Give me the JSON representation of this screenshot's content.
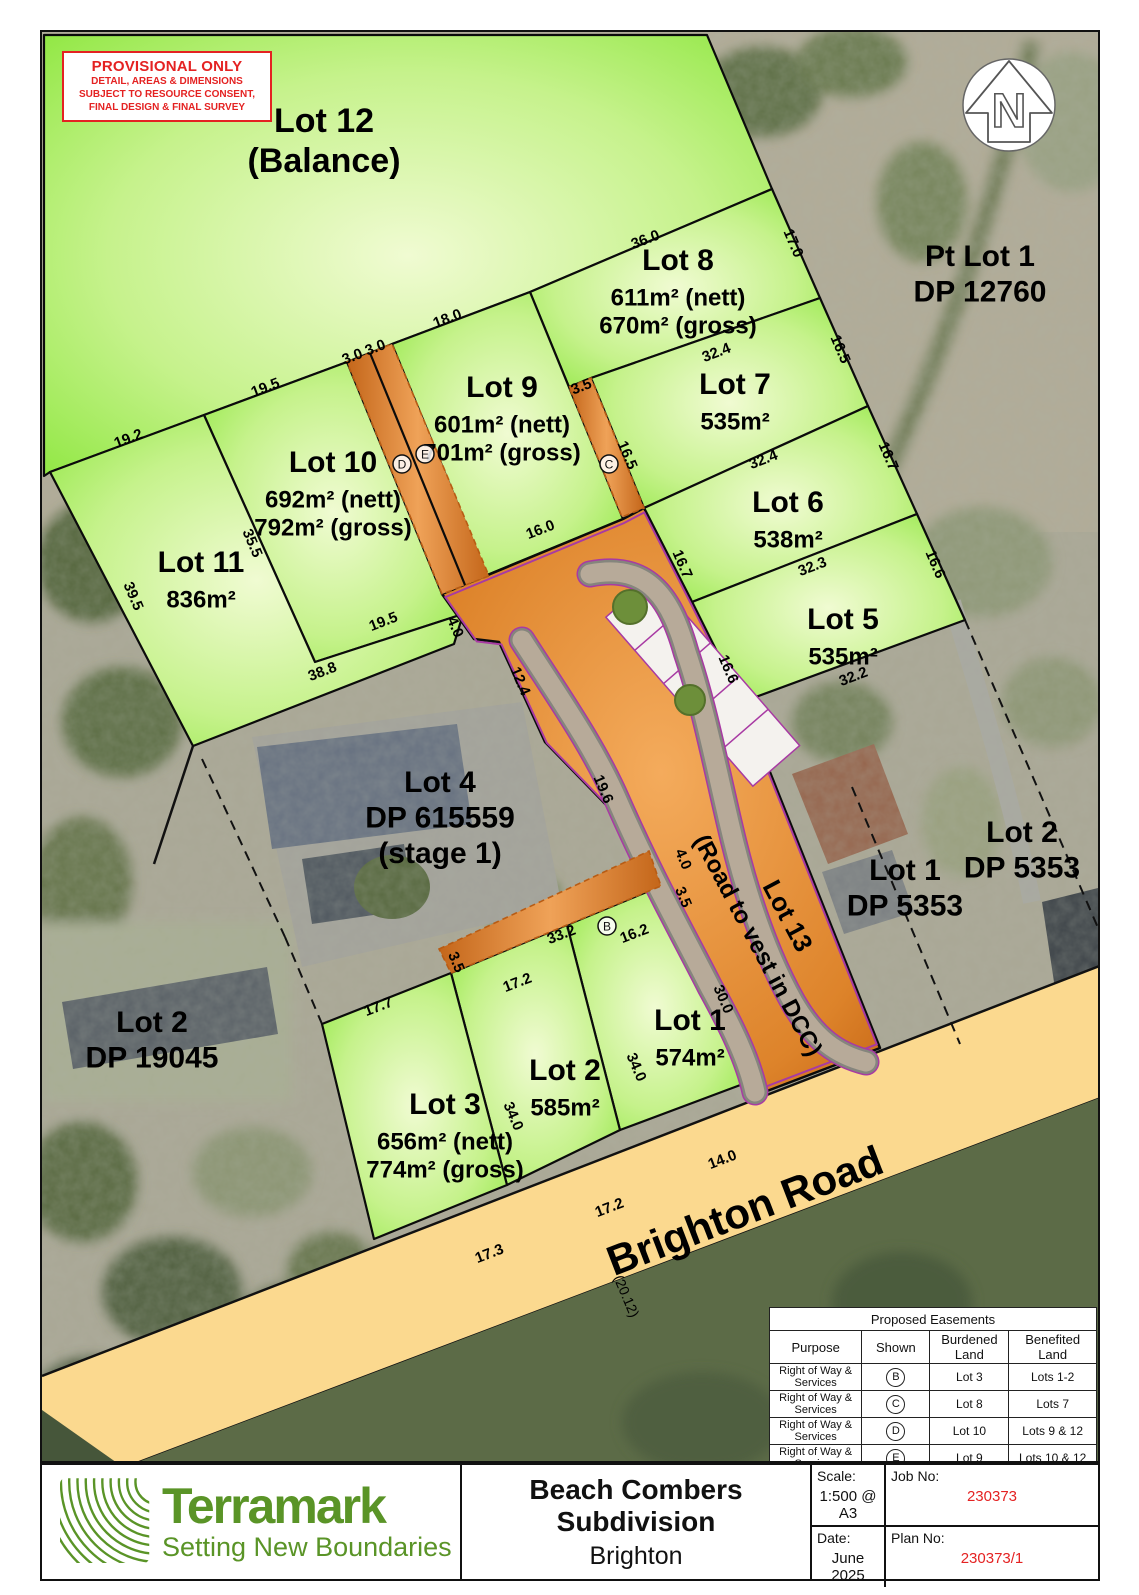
{
  "provisional": {
    "title": "PROVISIONAL ONLY",
    "lines": [
      "DETAIL, AREAS & DIMENSIONS",
      "SUBJECT TO RESOURCE CONSENT,",
      "FINAL DESIGN & FINAL SURVEY"
    ]
  },
  "north": {
    "letter": "N"
  },
  "map": {
    "dimensions": [
      [
        "36.0",
        645,
        242,
        -21
      ],
      [
        "17.0",
        787,
        243,
        67
      ],
      [
        "18.0",
        447,
        321,
        -21
      ],
      [
        "3.0",
        352,
        359,
        -21
      ],
      [
        "3.0",
        375,
        350,
        -21
      ],
      [
        "19.5",
        265,
        390,
        -21
      ],
      [
        "19.2",
        128,
        441,
        -21
      ],
      [
        "3.5",
        581,
        389,
        -21
      ],
      [
        "32.4",
        716,
        355,
        -21
      ],
      [
        "16.5",
        834,
        349,
        67
      ],
      [
        "16.5",
        621,
        455,
        67
      ],
      [
        "32.4",
        763,
        462,
        -21
      ],
      [
        "16.7",
        882,
        456,
        67
      ],
      [
        "16.7",
        676,
        564,
        67
      ],
      [
        "32.3",
        812,
        569,
        -21
      ],
      [
        "16.6",
        929,
        564,
        67
      ],
      [
        "16.6",
        722,
        669,
        67
      ],
      [
        "32.2",
        853,
        679,
        -21
      ],
      [
        "35.5",
        246,
        543,
        67
      ],
      [
        "39.5",
        127,
        596,
        67
      ],
      [
        "19.5",
        383,
        624,
        -21
      ],
      [
        "4.0",
        449,
        627,
        67
      ],
      [
        "38.8",
        322,
        674,
        -21
      ],
      [
        "16.0",
        540,
        532,
        -21
      ],
      [
        "12.4",
        514,
        681,
        67
      ],
      [
        "19.6",
        597,
        789,
        67
      ],
      [
        "4.0",
        677,
        859,
        67
      ],
      [
        "3.5",
        677,
        897,
        67
      ],
      [
        "33.2",
        561,
        937,
        -21
      ],
      [
        "16.2",
        634,
        936,
        -21
      ],
      [
        "17.2",
        517,
        985,
        -21
      ],
      [
        "3.5",
        450,
        962,
        67
      ],
      [
        "17.7",
        378,
        1009,
        -21
      ],
      [
        "30.0",
        717,
        999,
        67
      ],
      [
        "34.0",
        630,
        1067,
        67
      ],
      [
        "34.0",
        507,
        1116,
        67
      ],
      [
        "17.2",
        609,
        1210,
        -21
      ],
      [
        "14.0",
        722,
        1162,
        -21
      ],
      [
        "17.3",
        489,
        1256,
        -21
      ]
    ],
    "road_width_dim": "(20.12)",
    "lot_labels": [
      {
        "name": "lot-12-label",
        "x": 322,
        "y": 130,
        "lines": [
          {
            "t": "Lot 12",
            "s": 34
          },
          {
            "t": "(Balance)",
            "s": 34
          }
        ]
      },
      {
        "name": "pt-lot-1-label",
        "x": 978,
        "y": 264,
        "lines": [
          {
            "t": "Pt Lot 1",
            "s": 30
          },
          {
            "t": "DP 12760",
            "s": 30
          }
        ]
      },
      {
        "name": "lot-8-label",
        "x": 676,
        "y": 268,
        "lines": [
          {
            "t": "Lot 8",
            "s": 30
          },
          {
            "t": "611m² (nett)",
            "s": 24
          },
          {
            "t": "670m² (gross)",
            "s": 24
          }
        ]
      },
      {
        "name": "lot-7-label",
        "x": 733,
        "y": 392,
        "lines": [
          {
            "t": "Lot 7",
            "s": 30
          },
          {
            "t": "535m²",
            "s": 24
          }
        ]
      },
      {
        "name": "lot-9-label",
        "x": 500,
        "y": 395,
        "lines": [
          {
            "t": "Lot 9",
            "s": 30
          },
          {
            "t": "601m² (nett)",
            "s": 24
          },
          {
            "t": "701m² (gross)",
            "s": 24
          }
        ]
      },
      {
        "name": "lot-10-label",
        "x": 331,
        "y": 470,
        "lines": [
          {
            "t": "Lot 10",
            "s": 30
          },
          {
            "t": "692m² (nett)",
            "s": 24
          },
          {
            "t": "792m² (gross)",
            "s": 24
          }
        ]
      },
      {
        "name": "lot-11-label",
        "x": 199,
        "y": 570,
        "lines": [
          {
            "t": "Lot 11",
            "s": 30
          },
          {
            "t": "836m²",
            "s": 24
          }
        ]
      },
      {
        "name": "lot-6-label",
        "x": 786,
        "y": 510,
        "lines": [
          {
            "t": "Lot 6",
            "s": 30
          },
          {
            "t": "538m²",
            "s": 24
          }
        ]
      },
      {
        "name": "lot-5-label",
        "x": 841,
        "y": 627,
        "lines": [
          {
            "t": "Lot 5",
            "s": 30
          },
          {
            "t": "535m²",
            "s": 24
          }
        ]
      },
      {
        "name": "lot-4-label",
        "x": 438,
        "y": 790,
        "lines": [
          {
            "t": "Lot 4",
            "s": 30
          },
          {
            "t": "DP 615559",
            "s": 30
          },
          {
            "t": "(stage 1)",
            "s": 30
          }
        ]
      },
      {
        "name": "lot-1-label",
        "x": 688,
        "y": 1028,
        "lines": [
          {
            "t": "Lot 1",
            "s": 30
          },
          {
            "t": "574m²",
            "s": 24
          }
        ]
      },
      {
        "name": "lot-2-label",
        "x": 563,
        "y": 1078,
        "lines": [
          {
            "t": "Lot 2",
            "s": 30
          },
          {
            "t": "585m²",
            "s": 24
          }
        ]
      },
      {
        "name": "lot-3-label",
        "x": 443,
        "y": 1112,
        "lines": [
          {
            "t": "Lot 3",
            "s": 30
          },
          {
            "t": "656m² (nett)",
            "s": 24
          },
          {
            "t": "774m² (gross)",
            "s": 24
          }
        ]
      },
      {
        "name": "lot-2-dp-19045-label",
        "x": 150,
        "y": 1030,
        "lines": [
          {
            "t": "Lot 2",
            "s": 30
          },
          {
            "t": "DP 19045",
            "s": 30
          }
        ]
      },
      {
        "name": "lot-1-dp-5353-label",
        "x": 903,
        "y": 878,
        "lines": [
          {
            "t": "Lot 1",
            "s": 30
          },
          {
            "t": "DP 5353",
            "s": 30
          }
        ]
      },
      {
        "name": "lot-2-dp-5353-label",
        "x": 1020,
        "y": 840,
        "lines": [
          {
            "t": "Lot 2",
            "s": 30
          },
          {
            "t": "DP 5353",
            "s": 30
          }
        ]
      },
      {
        "name": "lot-13-label",
        "x": 778,
        "y": 918,
        "r": 62,
        "lines": [
          {
            "t": "Lot 13",
            "s": 26
          }
        ]
      },
      {
        "name": "road-vest-label",
        "x": 749,
        "y": 947,
        "r": 62,
        "lines": [
          {
            "t": "(Road to vest in DCC)",
            "s": 24
          }
        ]
      },
      {
        "name": "brighton-road-label",
        "x": 748,
        "y": 1222,
        "r": -21,
        "lines": [
          {
            "t": "Brighton Road",
            "s": 42
          }
        ]
      }
    ],
    "easement_marks": [
      {
        "t": "B",
        "x": 605,
        "y": 924
      },
      {
        "t": "C",
        "x": 607,
        "y": 462
      },
      {
        "t": "D",
        "x": 400,
        "y": 462
      },
      {
        "t": "E",
        "x": 423,
        "y": 452
      }
    ]
  },
  "easements_table": {
    "title": "Proposed Easements",
    "headers": [
      "Purpose",
      "Shown",
      "Burdened Land",
      "Benefited Land"
    ],
    "rows": [
      {
        "purpose": "Right of Way & Services",
        "shown": "B",
        "burdened": "Lot 3",
        "benefited": "Lots 1-2"
      },
      {
        "purpose": "Right of Way & Services",
        "shown": "C",
        "burdened": "Lot 8",
        "benefited": "Lots 7"
      },
      {
        "purpose": "Right of Way & Services",
        "shown": "D",
        "burdened": "Lot 10",
        "benefited": "Lots 9 & 12"
      },
      {
        "purpose": "Right of Way & Services",
        "shown": "E",
        "burdened": "Lot 9",
        "benefited": "Lots 10 & 12"
      }
    ]
  },
  "title_block": {
    "logo_text": "Terramark",
    "logo_tagline": "Setting New Boundaries",
    "title": "Beach Combers Subdivision",
    "subtitle": "Brighton",
    "scale_label": "Scale:",
    "scale_value": "1:500 @ A3",
    "job_label": "Job No:",
    "job_value": "230373",
    "date_label": "Date:",
    "date_value": "June 2025",
    "plan_label": "Plan No:",
    "plan_value": "230373/1"
  },
  "colors": {
    "lot_green_edge": "#8ae63a",
    "road_orange": "#e08c2e",
    "brighton_yellow": "#fbd98f",
    "boundary_purple": "#a83aa3",
    "brand_green": "#5a9427",
    "warning_red": "#e42222"
  }
}
